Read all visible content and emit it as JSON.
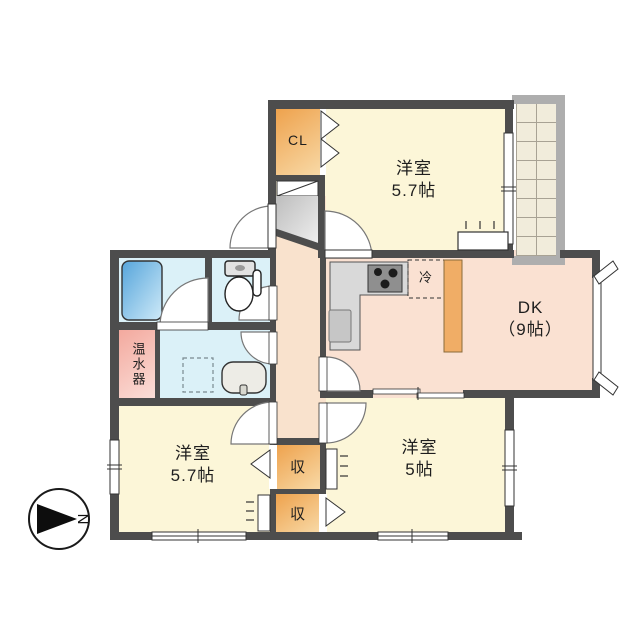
{
  "rooms": {
    "bedroom_top": {
      "name": "洋室",
      "size": "5.7帖"
    },
    "dk": {
      "name": "DK",
      "size": "（9帖）"
    },
    "bedroom_left": {
      "name": "洋室",
      "size": "5.7帖"
    },
    "bedroom_right": {
      "name": "洋室",
      "size": "5帖"
    }
  },
  "features": {
    "closet": "CL",
    "storage_upper": "収",
    "storage_lower": "収",
    "water_heater": "温水器",
    "refrigerator": "冷"
  },
  "compass": {
    "north": "N"
  },
  "colors": {
    "wall": "#4d4d4d",
    "bedroom": "#fcf6d8",
    "dining_kitchen": "#fae1d2",
    "corridor": "#f9e2cd",
    "wet_area": "#dbf1f8",
    "closet": "#f0a85c",
    "water_heater": "#f5b4aa",
    "balcony_tile": "#f1ecdb",
    "genkan": "#cfcfcf"
  }
}
